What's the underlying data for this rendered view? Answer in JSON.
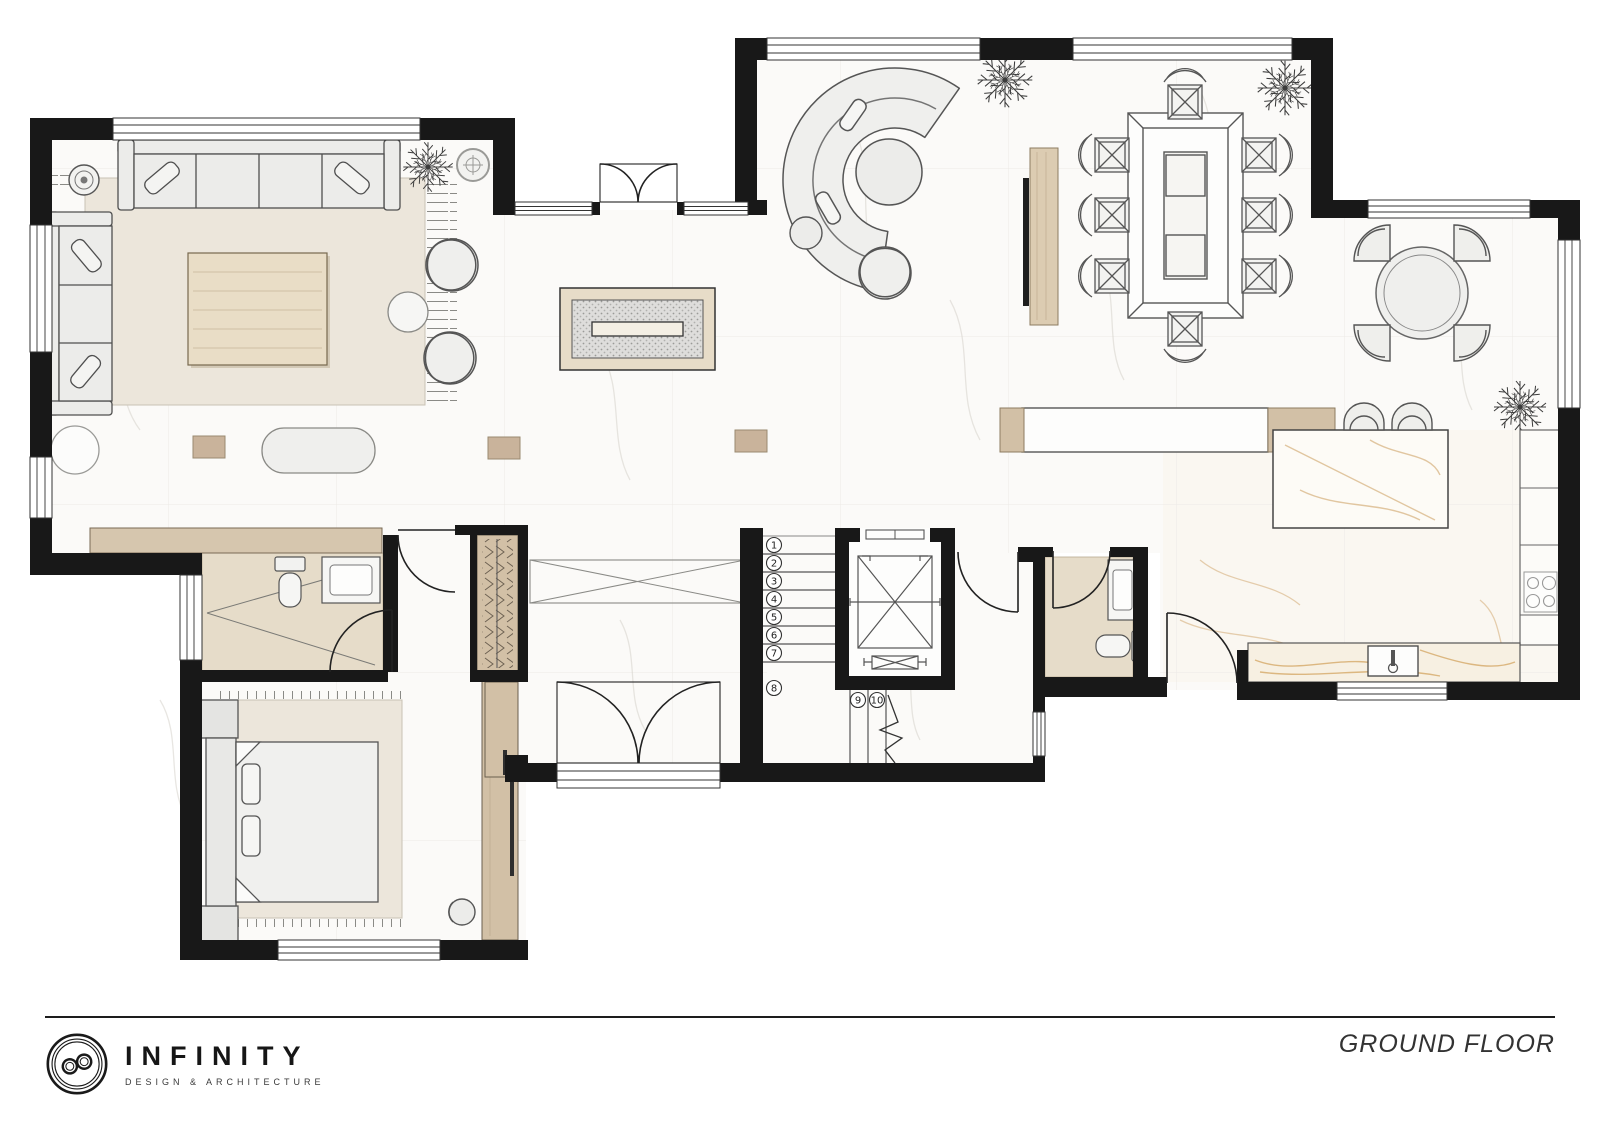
{
  "footer": {
    "title": "GROUND FLOOR"
  },
  "brand": {
    "name": "INFINITY",
    "tagline": "DESIGN & ARCHITECTURE"
  },
  "stairs": {
    "upper_steps": [
      "1",
      "2",
      "3",
      "4",
      "5",
      "6",
      "7",
      "8"
    ],
    "lower_steps": [
      "9",
      "10"
    ]
  },
  "palette": {
    "wall": "#181818",
    "floor": "#fbfaf8",
    "floor_vein": "#d6d2cb",
    "rug": "#ebe5da",
    "wood": "#d2c0a6",
    "bath_tile": "#e6dcc9",
    "gold_marble": "#c9913f",
    "furniture_fill": "#ececea",
    "furniture_line": "#4f4f4f"
  }
}
